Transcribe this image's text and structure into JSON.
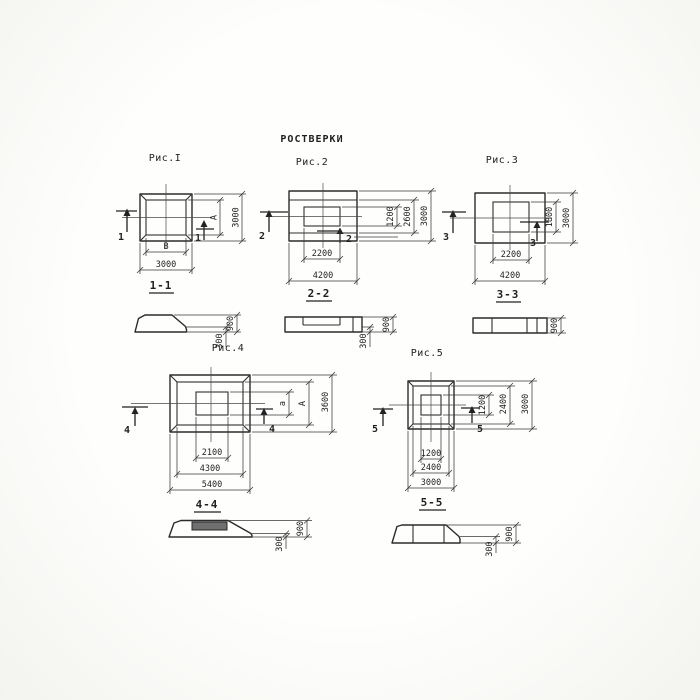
{
  "title": "РОСТВЕРКИ",
  "colors": {
    "ink": "#2b2b2b",
    "paper": "#fcfcfa"
  },
  "fig1": {
    "caption": "Рис.I",
    "section_label": "1-1",
    "marker": "1",
    "dim_inner_width": "В",
    "dim_outer_width": "3000",
    "dim_inner_height": "А",
    "dim_outer_height": "3000"
  },
  "fig2": {
    "caption": "Рис.2",
    "section_label": "2-2",
    "marker": "2",
    "dim_inner_width": "2200",
    "dim_outer_width": "4200",
    "dim_core_height": "1200",
    "dim_mid_height": "2600",
    "dim_outer_height": "3000"
  },
  "fig3": {
    "caption": "Рис.3",
    "section_label": "3-3",
    "marker": "3",
    "dim_inner_width": "2200",
    "dim_outer_width": "4200",
    "dim_inner_height": "1800",
    "dim_outer_height": "3000"
  },
  "fig4": {
    "caption": "Рис.4",
    "section_label": "4-4",
    "marker": "4",
    "dim_core_width": "2100",
    "dim_mid_width": "4300",
    "dim_outer_width": "5400",
    "dim_core_height": "а",
    "dim_mid_height": "А",
    "dim_outer_height": "3600"
  },
  "fig5": {
    "caption": "Рис.5",
    "section_label": "5-5",
    "marker": "5",
    "dim_core_width": "1200",
    "dim_mid_width": "2400",
    "dim_outer_width": "3000",
    "dim_core_height": "1200",
    "dim_mid_height": "2400",
    "dim_outer_height": "3000"
  },
  "sections": {
    "s1": {
      "height_total": "900",
      "height_edge": "300"
    },
    "s2": {
      "height_total": "900",
      "height_edge": "300"
    },
    "s3": {
      "height_total": "900"
    },
    "s4": {
      "height_total": "900",
      "height_edge": "300"
    },
    "s5": {
      "height_total": "900",
      "height_edge": "300"
    }
  }
}
